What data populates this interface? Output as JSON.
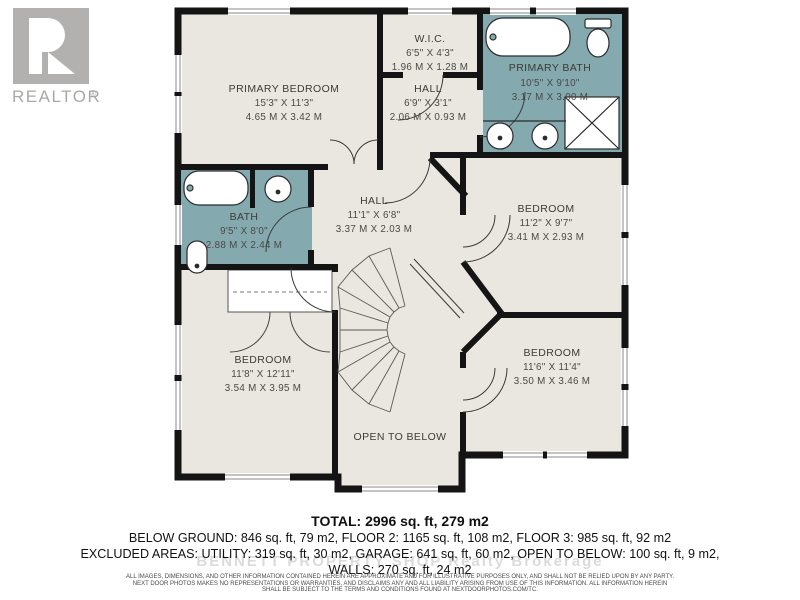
{
  "logo": {
    "brand": "REALTOR",
    "reg": "®"
  },
  "plan": {
    "colors": {
      "floor": "#e9e7df",
      "bath_floor": "#84a9af",
      "wall": "#141414"
    },
    "rooms": {
      "primary_bedroom": {
        "name": "PRIMARY BEDROOM",
        "imperial": "15'3\" X 11'3\"",
        "metric": "4.65 M X 3.42 M"
      },
      "wic": {
        "name": "W.I.C.",
        "imperial": "6'5\" X 4'3\"",
        "metric": "1.96 M X 1.28 M"
      },
      "hall_upper": {
        "name": "HALL",
        "imperial": "6'9\" X 3'1\"",
        "metric": "2.06 M X 0.93 M"
      },
      "primary_bath": {
        "name": "PRIMARY BATH",
        "imperial": "10'5\" X 9'10\"",
        "metric": "3.17 M X 3.00 M"
      },
      "bath": {
        "name": "BATH",
        "imperial": "9'5\" X 8'0\"",
        "metric": "2.88 M X 2.44 M"
      },
      "hall_center": {
        "name": "HALL",
        "imperial": "11'1\" X 6'8\"",
        "metric": "3.37 M X 2.03 M"
      },
      "bedroom_right": {
        "name": "BEDROOM",
        "imperial": "11'2\" X 9'7\"",
        "metric": "3.41 M X 2.93 M"
      },
      "bedroom_bl": {
        "name": "BEDROOM",
        "imperial": "11'8\" X 12'11\"",
        "metric": "3.54 M X 3.95 M"
      },
      "bedroom_br": {
        "name": "BEDROOM",
        "imperial": "11'6\" X 11'4\"",
        "metric": "3.50 M X 3.46 M"
      }
    },
    "open_to_below": "OPEN TO BELOW"
  },
  "summary": {
    "total": "TOTAL: 2996 sq. ft, 279 m2",
    "line2": "BELOW GROUND: 846 sq. ft, 79 m2, FLOOR 2: 1165 sq. ft, 108 m2, FLOOR 3: 985 sq. ft, 92 m2",
    "line3": "EXCLUDED AREAS: UTILITY: 319 sq. ft, 30 m2, GARAGE: 641 sq. ft, 60 m2, OPEN TO BELOW: 100 sq. ft, 9 m2,",
    "line4": "WALLS: 270 sq. ft, 24 m2"
  },
  "watermark": "BENNETT PROPERTY SHOP Realty Brokerage",
  "disclaimer": {
    "line1": "ALL IMAGES, DIMENSIONS, AND OTHER INFORMATION CONTAINED HEREIN ARE APPROXIMATE AND FOR ILLUSTRATIVE PURPOSES ONLY, AND SHALL NOT BE RELIED UPON BY ANY PARTY.",
    "line2": "NEXT DOOR PHOTOS MAKES NO REPRESENTATIONS OR WARRANTIES, AND DISCLAIMS ANY AND ALL LIABILITY ARISING FROM USE OF THIS INFORMATION. ALL INFORMATION HEREIN",
    "line3": "SHALL BE SUBJECT TO THE TERMS AND CONDITIONS FOUND AT NEXTDOORPHOTOS.COM/TC."
  }
}
